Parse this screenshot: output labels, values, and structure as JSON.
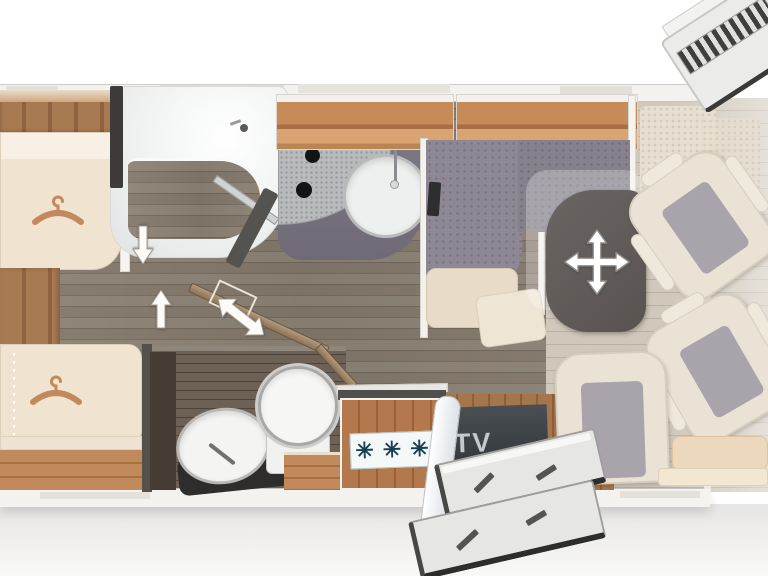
{
  "type": "motorhome-floorplan-diagram",
  "labels": {
    "tv": "TV"
  },
  "appliance_symbols": {
    "fridge_freezer": [
      "✳",
      "✳",
      "✳"
    ]
  },
  "icons": {
    "hanger-icon": "wardrobe clothes hanger",
    "arrow-down-icon": "walkway direction down",
    "arrow-up-icon": "walkway direction up",
    "door-swing-arrow-icon": "sliding door travel double arrow",
    "move-table-arrow-icon": "four-way adjustable table arrow",
    "snowflake-icon": "refrigerator freezer symbol",
    "shower-head-icon": "shower head"
  },
  "colors": {
    "wood_cabinet": "#c78a59",
    "floor_corridor": "#83786b",
    "floor_washroom": "#64564a",
    "floor_cab": "#c9c0b1",
    "mattress": "#f0e3d0",
    "upholstery_gray": "#8e8894",
    "table_top": "#615b58",
    "tv_panel": "#3a4044",
    "tv_text": "#c5c9cc",
    "fridge_symbol": "#17404f",
    "seat_cream": "#eae2d4",
    "seat_cushion_gray": "#a9a3ab",
    "arrow_white": "#ffffff",
    "hanger": "#c28a5c"
  },
  "components": [
    "rear-single-bed-top",
    "rear-single-bed-bottom",
    "wardrobe-planks",
    "shower-room",
    "sliding-door",
    "washroom",
    "washbasin",
    "toilet",
    "kitchen-counter",
    "kitchen-sink",
    "hob",
    "overhead-cabinets",
    "refrigerator",
    "dinette-bench",
    "adjustable-table",
    "tv",
    "side-seat",
    "rear-bench",
    "driver-seat",
    "passenger-seat",
    "entry-door",
    "entry-steps",
    "cab-door-step",
    "cab-rug"
  ]
}
